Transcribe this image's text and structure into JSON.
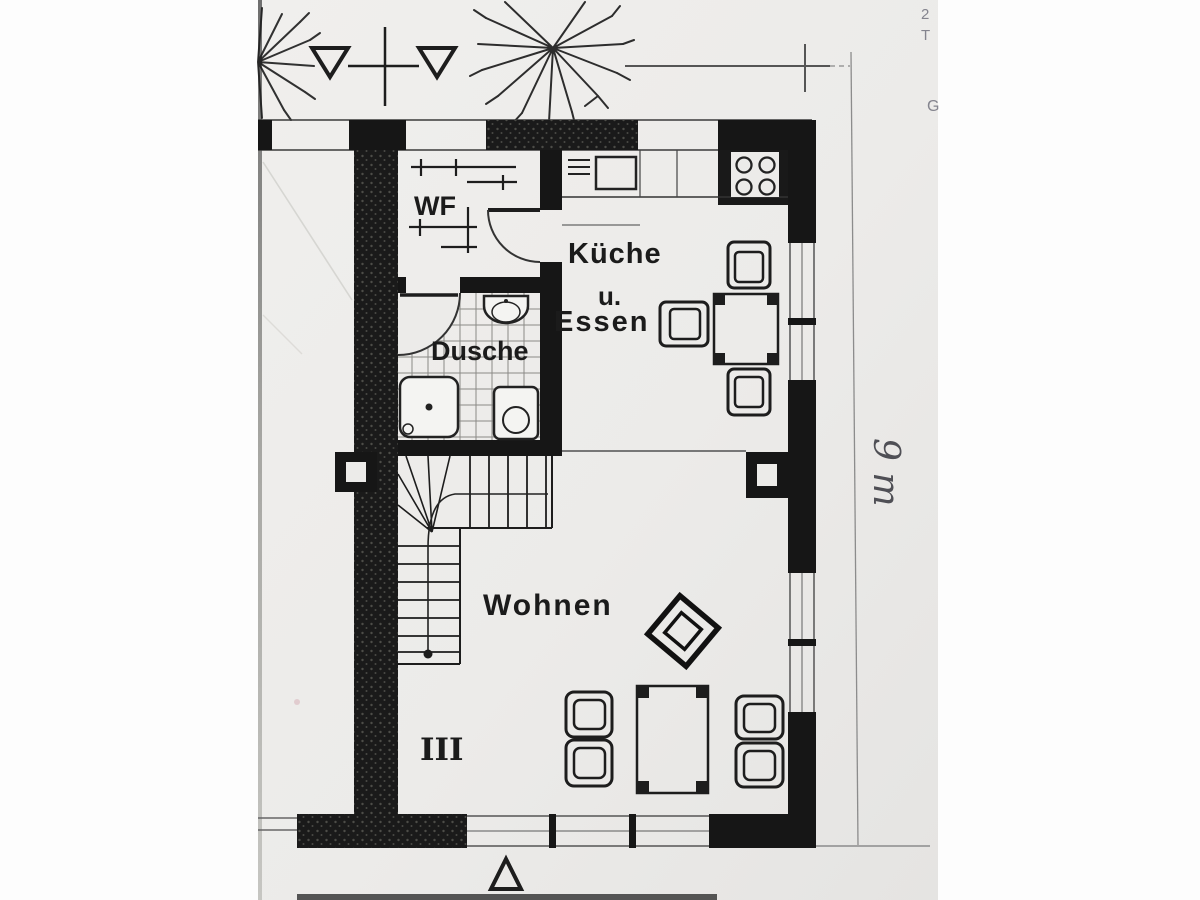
{
  "photo": {
    "description": "Scanned black-and-white floor plan photograph (ground floor of a terraced holiday house)"
  },
  "labels": {
    "entry": "WF",
    "kitchen": "Küche",
    "kitchen_conj": "u.",
    "kitchen2": "Essen",
    "shower": "Dusche",
    "living": "Wohnen",
    "stair_mark": "III",
    "dimension_note": "9 m"
  },
  "margin_fragments": {
    "a": "2",
    "b": "T",
    "c": "G"
  },
  "colors": {
    "ink": "#1d1d1d",
    "paper": "#edecea",
    "margin": "#fdfdfd",
    "faint_line": "#9a9a9a",
    "handwriting": "#4f4f55"
  },
  "icons": [
    "tree-icon",
    "section-marker-icon",
    "door-arc-icon",
    "shower-tray-icon",
    "toilet-icon",
    "washbasin-icon",
    "kitchen-sink-icon",
    "stove-icon",
    "stairs-icon",
    "walking-line-icon",
    "entrance-triangle-icon",
    "dimension-line",
    "chimney-block",
    "radiator-mark",
    "wardrobe-mark",
    "dining-table",
    "dining-chair",
    "coffee-table",
    "armchair",
    "plant-stand"
  ]
}
